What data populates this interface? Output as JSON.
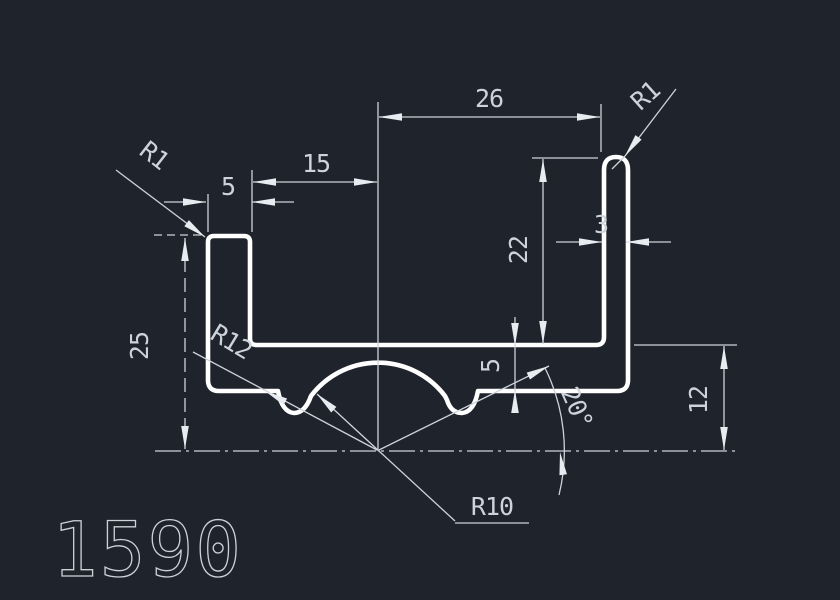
{
  "drawing": {
    "profile_number": "1590",
    "colors": {
      "background": "#1e232c",
      "profile_line": "#ffffff",
      "dimension_line": "#cdd3da",
      "dimension_text": "#cdd3da"
    },
    "dims": {
      "top_width": "26",
      "left_opening": "15",
      "left_wall_thickness": "5",
      "left_corner_radius": "R1",
      "right_corner_radius": "R1",
      "right_wall_thickness": "3",
      "cavity_depth": "22",
      "overall_height": "25",
      "groove_radius": "R12",
      "base_thickness": "5",
      "angle": "20°",
      "base_height": "12",
      "dome_radius": "R10"
    }
  }
}
